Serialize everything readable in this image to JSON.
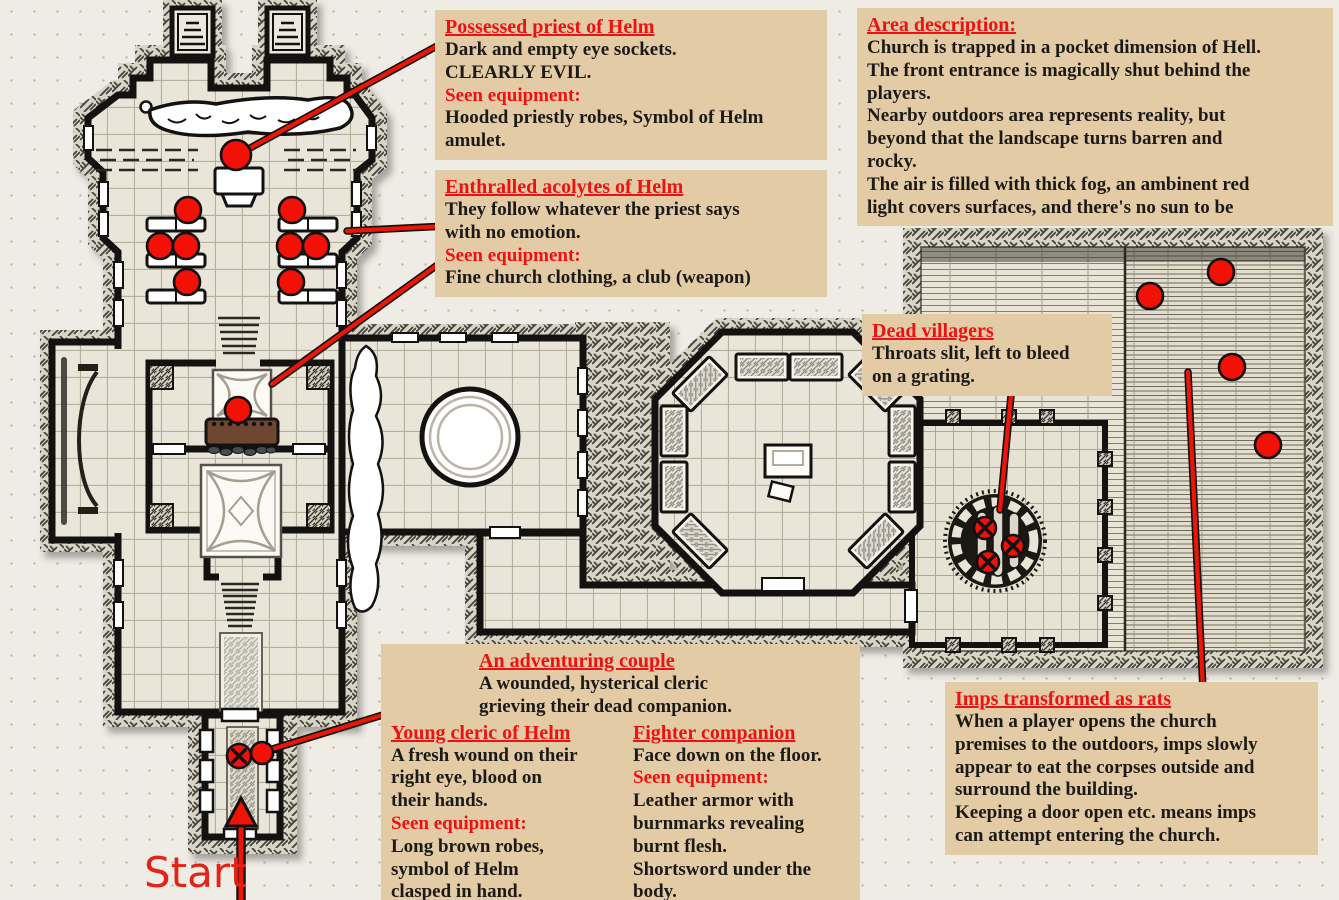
{
  "palette": {
    "box_bg": "#e3cba6",
    "accent_red": "#ee1111",
    "marker_red": "#f31007",
    "text": "#1c1a17",
    "page_bg": "#efece5"
  },
  "start": {
    "label": "Start"
  },
  "boxes": {
    "priest": {
      "title": "Possessed priest of Helm",
      "body": "Dark and empty eye sockets.\nCLEARLY EVIL.",
      "equipment_label": "Seen equipment:",
      "equipment": "Hooded priestly robes, Symbol of Helm\namulet."
    },
    "acolytes": {
      "title": "Enthralled acolytes of Helm",
      "body": "They follow whatever the priest says\nwith no emotion.",
      "equipment_label": "Seen equipment:",
      "equipment": "Fine church clothing, a club (weapon)"
    },
    "area": {
      "title": "Area description:",
      "body": "Church is trapped in a pocket dimension of Hell.\nThe front entrance is magically shut behind the\nplayers.\nNearby outdoors area represents reality, but\nbeyond that the landscape turns barren and\nrocky.\nThe air is filled with thick fog, an ambinent red\nlight covers surfaces, and there's no sun to be"
    },
    "villagers": {
      "title": "Dead villagers",
      "body": "Throats slit, left to bleed\non a grating."
    },
    "couple": {
      "title": "An adventuring couple",
      "intro": "A wounded, hysterical cleric\ngrieving their dead companion.",
      "cleric": {
        "title": "Young cleric of Helm",
        "body": "A fresh wound on their\nright eye, blood on\ntheir hands.",
        "equipment_label": "Seen equipment:",
        "equipment": "Long brown robes,\nsymbol of Helm\nclasped in hand."
      },
      "fighter": {
        "title": "Fighter companion",
        "body": "Face down on the floor.",
        "equipment_label": "Seen equipment:",
        "equipment": "Leather armor with\nburnmarks revealing\nburnt flesh.\nShortsword under the\nbody."
      }
    },
    "imps": {
      "title": "Imps transformed as rats",
      "body": "When a player opens the church\npremises to the outdoors, imps slowly\nappear to eat the corpses outside and\nsurround the building.\nKeeping a door open etc. means imps\ncan attempt entering the church."
    }
  },
  "map": {
    "markers": [
      {
        "name": "possessed-priest",
        "x": 236,
        "y": 155,
        "r": 15,
        "dead": false
      },
      {
        "name": "acolyte-1",
        "x": 188,
        "y": 210,
        "r": 13,
        "dead": false
      },
      {
        "name": "acolyte-2",
        "x": 160,
        "y": 246,
        "r": 13,
        "dead": false
      },
      {
        "name": "acolyte-3",
        "x": 186,
        "y": 246,
        "r": 13,
        "dead": false
      },
      {
        "name": "acolyte-4",
        "x": 187,
        "y": 282,
        "r": 13,
        "dead": false
      },
      {
        "name": "acolyte-5",
        "x": 292,
        "y": 210,
        "r": 13,
        "dead": false
      },
      {
        "name": "acolyte-6",
        "x": 290,
        "y": 246,
        "r": 13,
        "dead": false
      },
      {
        "name": "acolyte-7",
        "x": 316,
        "y": 246,
        "r": 13,
        "dead": false
      },
      {
        "name": "acolyte-8",
        "x": 291,
        "y": 282,
        "r": 13,
        "dead": false
      },
      {
        "name": "acolyte-sanctuary",
        "x": 238,
        "y": 410,
        "r": 13,
        "dead": false
      },
      {
        "name": "young-cleric",
        "x": 262,
        "y": 753,
        "r": 11,
        "dead": false
      },
      {
        "name": "fighter-companion",
        "x": 239,
        "y": 756,
        "r": 12,
        "dead": true
      },
      {
        "name": "dead-villager-1",
        "x": 985,
        "y": 528,
        "r": 11,
        "dead": true
      },
      {
        "name": "dead-villager-2",
        "x": 1013,
        "y": 546,
        "r": 11,
        "dead": true
      },
      {
        "name": "dead-villager-3",
        "x": 988,
        "y": 562,
        "r": 11,
        "dead": true
      },
      {
        "name": "imp-rat-1",
        "x": 1150,
        "y": 296,
        "r": 13,
        "dead": false
      },
      {
        "name": "imp-rat-2",
        "x": 1221,
        "y": 272,
        "r": 13,
        "dead": false
      },
      {
        "name": "imp-rat-3",
        "x": 1232,
        "y": 367,
        "r": 13,
        "dead": false
      },
      {
        "name": "imp-rat-4",
        "x": 1268,
        "y": 445,
        "r": 13,
        "dead": false
      }
    ],
    "connectors": [
      {
        "name": "priest-note-line",
        "x1": 448,
        "y1": 40,
        "x2": 241,
        "y2": 153
      },
      {
        "name": "acolytes-note-line-1",
        "x1": 447,
        "y1": 226,
        "x2": 347,
        "y2": 231
      },
      {
        "name": "acolytes-note-line-2",
        "x1": 447,
        "y1": 258,
        "x2": 272,
        "y2": 384
      },
      {
        "name": "couple-note-line",
        "x1": 470,
        "y1": 688,
        "x2": 266,
        "y2": 751
      },
      {
        "name": "villagers-note-line",
        "x1": 1012,
        "y1": 385,
        "x2": 1000,
        "y2": 510
      },
      {
        "name": "imps-note-line",
        "x1": 1203,
        "y1": 690,
        "x2": 1188,
        "y2": 372
      }
    ]
  }
}
